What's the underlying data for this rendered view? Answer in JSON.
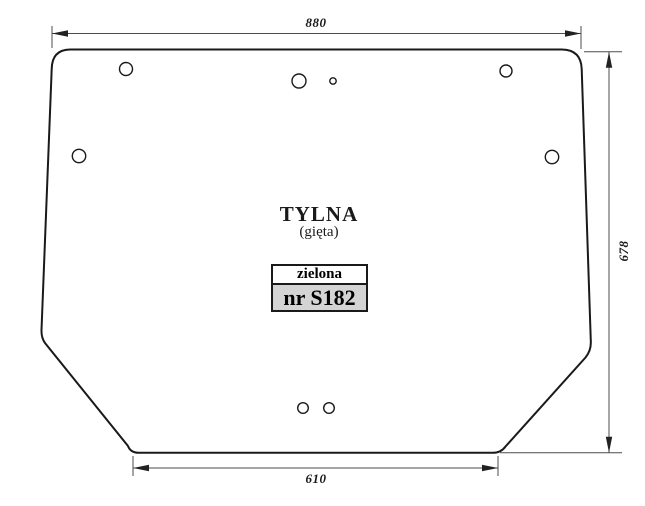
{
  "drawing": {
    "title": "TYLNA",
    "subtitle": "(gięta)",
    "spec_box": {
      "color_name": "zielona",
      "part_number": "nr S182"
    },
    "dimensions": {
      "width_top": "880",
      "height_right": "678",
      "width_bottom": "610"
    },
    "colors": {
      "outline": "#1a1a1a",
      "dimension_lines": "#4d4d4d",
      "spec_number_background": "#d4d4d4",
      "background": "#ffffff"
    }
  }
}
